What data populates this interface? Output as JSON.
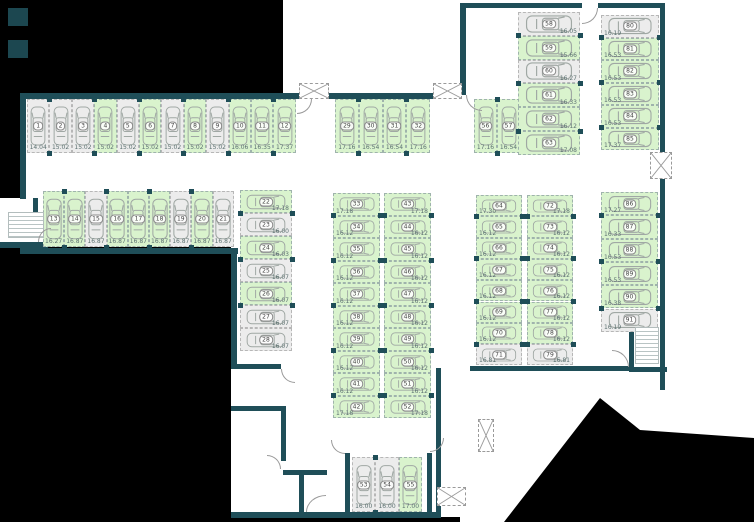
{
  "colors": {
    "background": "#000000",
    "floor": "#ffffff",
    "wall": "#1f4e58",
    "stall_available": "#d9f3cd",
    "stall_occupied": "#ececec"
  },
  "icons": {
    "car": "top-view car outline",
    "stairs": "stair treads hatch",
    "shaft": "dashed box with X cross",
    "door": "quarter-circle door swing arc"
  },
  "groups": [
    {
      "name": "row-stalls-1-12",
      "type": "v",
      "x": 27,
      "y": 99,
      "stall_w": 22.4,
      "stall_h": 54,
      "stalls": [
        {
          "num": "1",
          "dim": "14.04",
          "state": "occupied"
        },
        {
          "num": "2",
          "dim": "15.02",
          "state": "occupied"
        },
        {
          "num": "3",
          "dim": "15.02",
          "state": "occupied"
        },
        {
          "num": "4",
          "dim": "15.02",
          "state": "free"
        },
        {
          "num": "5",
          "dim": "15.02",
          "state": "occupied"
        },
        {
          "num": "6",
          "dim": "15.02",
          "state": "free"
        },
        {
          "num": "7",
          "dim": "15.02",
          "state": "occupied"
        },
        {
          "num": "8",
          "dim": "15.02",
          "state": "free"
        },
        {
          "num": "9",
          "dim": "15.02",
          "state": "occupied"
        },
        {
          "num": "10",
          "dim": "16.06",
          "state": "free"
        },
        {
          "num": "11",
          "dim": "16.35",
          "state": "free"
        },
        {
          "num": "12",
          "dim": "17.37",
          "state": "free"
        }
      ]
    },
    {
      "name": "row-stalls-13-21",
      "type": "v",
      "x": 43,
      "y": 191,
      "stall_w": 21.2,
      "stall_h": 56,
      "stalls": [
        {
          "num": "13",
          "dim": "16.27",
          "state": "free"
        },
        {
          "num": "14",
          "dim": "16.87",
          "state": "free"
        },
        {
          "num": "15",
          "dim": "16.87",
          "state": "occupied"
        },
        {
          "num": "16",
          "dim": "16.87",
          "state": "free"
        },
        {
          "num": "17",
          "dim": "16.87",
          "state": "free"
        },
        {
          "num": "18",
          "dim": "16.87",
          "state": "free"
        },
        {
          "num": "19",
          "dim": "16.87",
          "state": "occupied"
        },
        {
          "num": "20",
          "dim": "16.87",
          "state": "free"
        },
        {
          "num": "21",
          "dim": "16.87",
          "state": "occupied"
        }
      ]
    },
    {
      "name": "col-stalls-22-28",
      "type": "h",
      "dim_pos": "br",
      "x": 240,
      "y": 190,
      "stall_w": 52,
      "stall_h": 23,
      "stalls": [
        {
          "num": "22",
          "dim": "17.18",
          "state": "free"
        },
        {
          "num": "23",
          "dim": "16.00",
          "state": "occupied"
        },
        {
          "num": "24",
          "dim": "16.03",
          "state": "free"
        },
        {
          "num": "25",
          "dim": "16.07",
          "state": "occupied"
        },
        {
          "num": "26",
          "dim": "16.07",
          "state": "free"
        },
        {
          "num": "27",
          "dim": "16.07",
          "state": "occupied"
        },
        {
          "num": "28",
          "dim": "16.07",
          "state": "occupied"
        }
      ]
    },
    {
      "name": "row-stalls-29-32",
      "type": "v",
      "x": 335,
      "y": 99,
      "stall_w": 23.8,
      "stall_h": 54,
      "stalls": [
        {
          "num": "29",
          "dim": "17.16",
          "state": "free"
        },
        {
          "num": "30",
          "dim": "16.54",
          "state": "free"
        },
        {
          "num": "31",
          "dim": "16.54",
          "state": "free"
        },
        {
          "num": "32",
          "dim": "17.16",
          "state": "free"
        }
      ]
    },
    {
      "name": "col-stalls-33-42",
      "type": "h",
      "dim_pos": "bl",
      "x": 333,
      "y": 193,
      "stall_w": 47,
      "stall_h": 22.5,
      "stalls": [
        {
          "num": "33",
          "dim": "17.18",
          "state": "free"
        },
        {
          "num": "34",
          "dim": "16.12",
          "state": "free"
        },
        {
          "num": "35",
          "dim": "16.12",
          "state": "free"
        },
        {
          "num": "36",
          "dim": "16.12",
          "state": "free"
        },
        {
          "num": "37",
          "dim": "16.12",
          "state": "free"
        },
        {
          "num": "38",
          "dim": "16.12",
          "state": "free"
        },
        {
          "num": "39",
          "dim": "16.12",
          "state": "free"
        },
        {
          "num": "40",
          "dim": "16.12",
          "state": "free"
        },
        {
          "num": "41",
          "dim": "16.12",
          "state": "free"
        },
        {
          "num": "42",
          "dim": "17.18",
          "state": "free"
        }
      ]
    },
    {
      "name": "col-stalls-43-52",
      "type": "h",
      "dim_pos": "br",
      "x": 384,
      "y": 193,
      "stall_w": 47,
      "stall_h": 22.5,
      "stalls": [
        {
          "num": "43",
          "dim": "17.18",
          "state": "free"
        },
        {
          "num": "44",
          "dim": "16.12",
          "state": "free"
        },
        {
          "num": "45",
          "dim": "16.12",
          "state": "free"
        },
        {
          "num": "46",
          "dim": "16.12",
          "state": "free"
        },
        {
          "num": "47",
          "dim": "16.12",
          "state": "free"
        },
        {
          "num": "48",
          "dim": "16.12",
          "state": "free"
        },
        {
          "num": "49",
          "dim": "16.12",
          "state": "free"
        },
        {
          "num": "50",
          "dim": "16.12",
          "state": "free"
        },
        {
          "num": "51",
          "dim": "16.12",
          "state": "free"
        },
        {
          "num": "52",
          "dim": "17.18",
          "state": "free"
        }
      ]
    },
    {
      "name": "row-stalls-53-55",
      "type": "v",
      "x": 352,
      "y": 457,
      "stall_w": 23.4,
      "stall_h": 55,
      "stalls": [
        {
          "num": "53",
          "dim": "16.00",
          "state": "occupied"
        },
        {
          "num": "54",
          "dim": "16.00",
          "state": "occupied"
        },
        {
          "num": "55",
          "dim": "17.00",
          "state": "free"
        }
      ]
    },
    {
      "name": "row-stalls-56-57",
      "type": "v",
      "x": 474,
      "y": 99,
      "stall_w": 23,
      "stall_h": 54,
      "stalls": [
        {
          "num": "56",
          "dim": "17.16",
          "state": "free"
        },
        {
          "num": "57",
          "dim": "16.54",
          "state": "free"
        }
      ]
    },
    {
      "name": "col-stalls-58-63",
      "type": "h",
      "dim_pos": "br",
      "x": 518,
      "y": 12,
      "stall_w": 62,
      "stall_h": 23.8,
      "stalls": [
        {
          "num": "58",
          "dim": "16.05",
          "state": "occupied"
        },
        {
          "num": "59",
          "dim": "15.66",
          "state": "free"
        },
        {
          "num": "60",
          "dim": "16.27",
          "state": "occupied"
        },
        {
          "num": "61",
          "dim": "16.33",
          "state": "free"
        },
        {
          "num": "62",
          "dim": "16.12",
          "state": "free"
        },
        {
          "num": "63",
          "dim": "17.08",
          "state": "free"
        }
      ]
    },
    {
      "name": "col-stalls-80-85",
      "type": "h",
      "dim_pos": "bl",
      "x": 601,
      "y": 15,
      "stall_w": 58,
      "stall_h": 22.5,
      "stalls": [
        {
          "num": "80",
          "dim": "16.19",
          "state": "occupied"
        },
        {
          "num": "81",
          "dim": "16.53",
          "state": "free"
        },
        {
          "num": "82",
          "dim": "16.53",
          "state": "free"
        },
        {
          "num": "83",
          "dim": "16.53",
          "state": "free"
        },
        {
          "num": "84",
          "dim": "16.53",
          "state": "free"
        },
        {
          "num": "85",
          "dim": "17.37",
          "state": "free"
        }
      ]
    },
    {
      "name": "col-stalls-64-71",
      "type": "h",
      "dim_pos": "bl",
      "x": 476,
      "y": 195,
      "stall_w": 46,
      "stall_h": 21.3,
      "stalls": [
        {
          "num": "64",
          "dim": "17.30",
          "state": "free"
        },
        {
          "num": "65",
          "dim": "16.12",
          "state": "free"
        },
        {
          "num": "66",
          "dim": "16.12",
          "state": "free"
        },
        {
          "num": "67",
          "dim": "16.12",
          "state": "free"
        },
        {
          "num": "68",
          "dim": "16.12",
          "state": "free"
        },
        {
          "num": "69",
          "dim": "16.12",
          "state": "free"
        },
        {
          "num": "70",
          "dim": "16.12",
          "state": "free"
        },
        {
          "num": "71",
          "dim": "16.81",
          "state": "occupied"
        }
      ]
    },
    {
      "name": "col-stalls-72-79",
      "type": "h",
      "dim_pos": "br",
      "x": 527,
      "y": 195,
      "stall_w": 46,
      "stall_h": 21.3,
      "stalls": [
        {
          "num": "72",
          "dim": "17.18",
          "state": "free"
        },
        {
          "num": "73",
          "dim": "16.12",
          "state": "free"
        },
        {
          "num": "74",
          "dim": "16.12",
          "state": "free"
        },
        {
          "num": "75",
          "dim": "16.12",
          "state": "free"
        },
        {
          "num": "76",
          "dim": "16.12",
          "state": "free"
        },
        {
          "num": "77",
          "dim": "16.12",
          "state": "free"
        },
        {
          "num": "78",
          "dim": "16.12",
          "state": "free"
        },
        {
          "num": "79",
          "dim": "16.81",
          "state": "occupied"
        }
      ]
    },
    {
      "name": "col-stalls-86-91",
      "type": "h",
      "dim_pos": "bl",
      "x": 601,
      "y": 192,
      "stall_w": 57,
      "stall_h": 23.3,
      "stalls": [
        {
          "num": "86",
          "dim": "17.27",
          "state": "free"
        },
        {
          "num": "87",
          "dim": "16.33",
          "state": "free"
        },
        {
          "num": "88",
          "dim": "16.53",
          "state": "free"
        },
        {
          "num": "89",
          "dim": "16.53",
          "state": "free"
        },
        {
          "num": "90",
          "dim": "16.38",
          "state": "free"
        },
        {
          "num": "91",
          "dim": "16.19",
          "state": "occupied"
        }
      ]
    }
  ]
}
